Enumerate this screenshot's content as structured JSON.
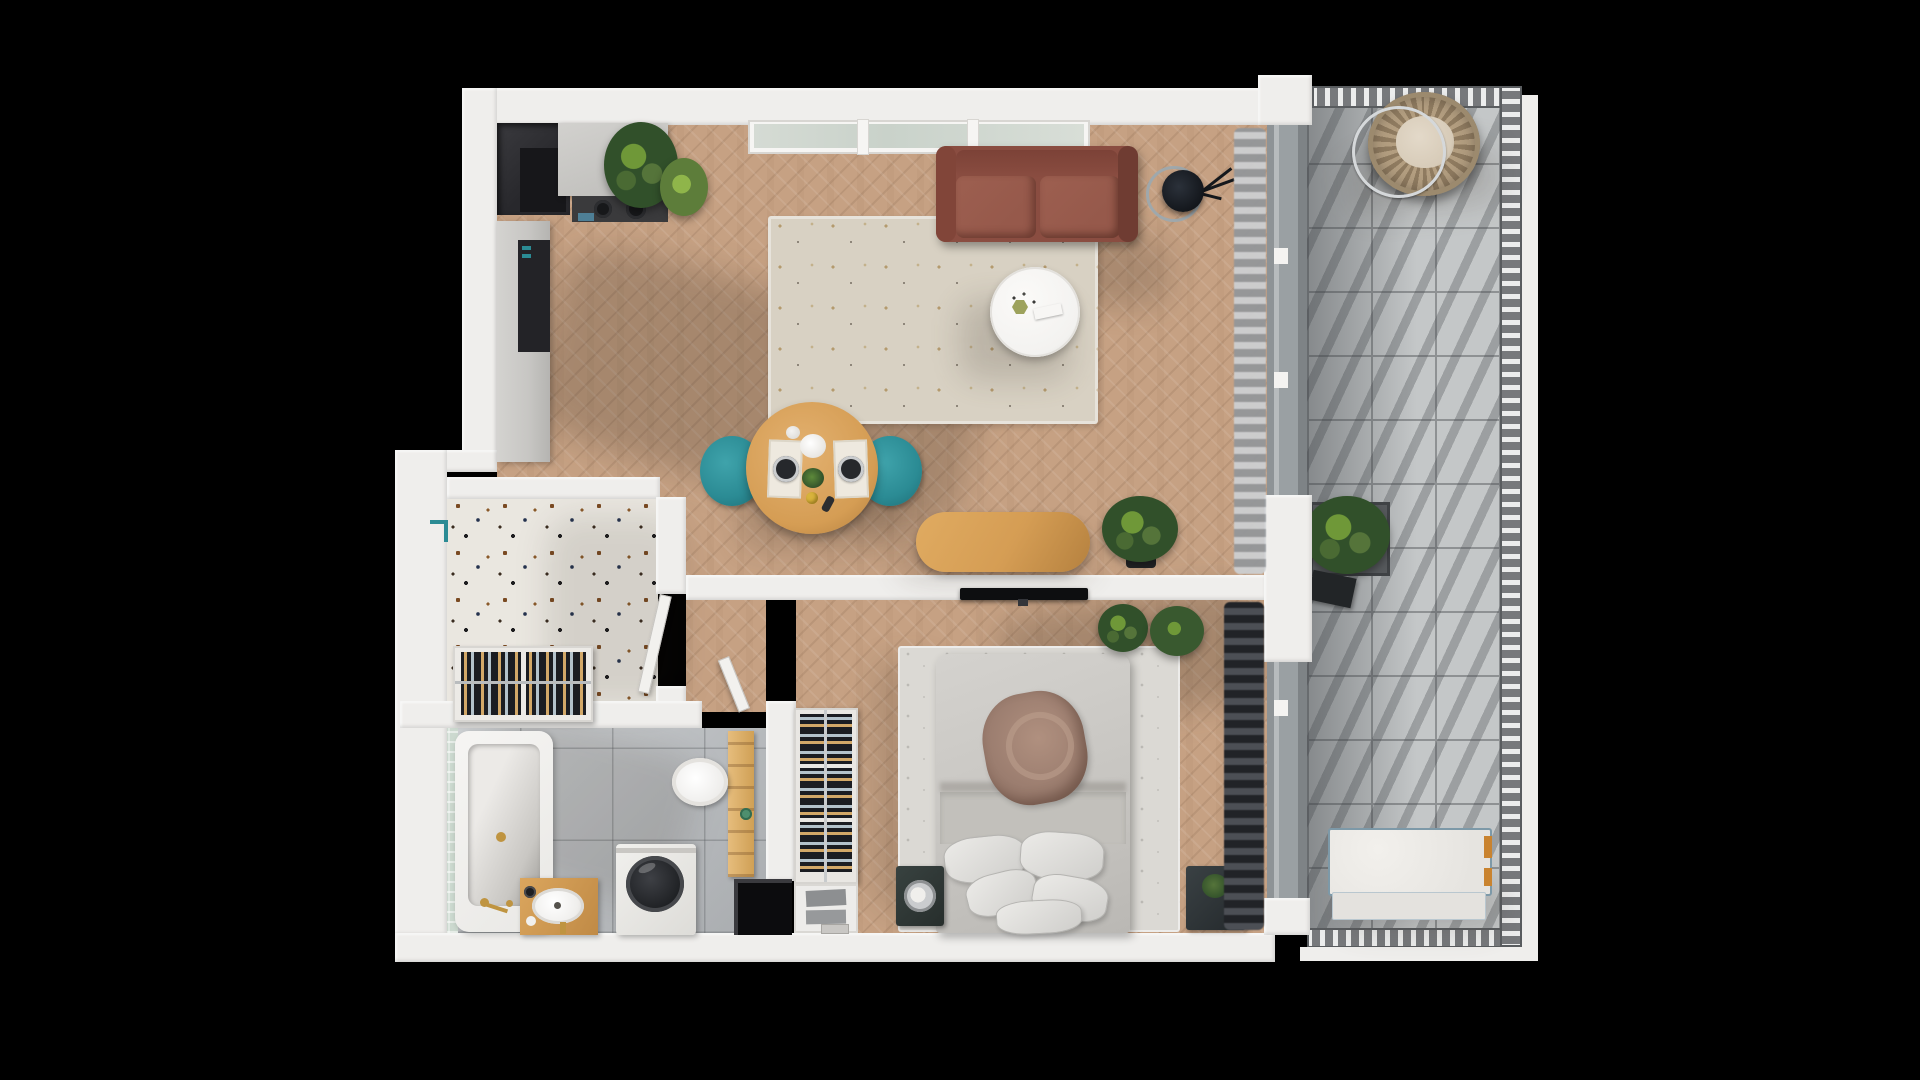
{
  "scene": {
    "type": "3d-floor-plan-top-view",
    "subject": "one-bedroom apartment with wraparound balcony",
    "background": "#000000"
  },
  "colors": {
    "wall": "#efeeec",
    "wood": "#c6a183",
    "terrazzo": "#eae7e0",
    "tileBath": "#b9bcbf",
    "tileBathLight": "#cfd2d4",
    "mosaic": "#ccd9cf",
    "balconyTile": "#c4c7c8",
    "grout": "#8e9193",
    "rail": "#77797c",
    "railLight": "#eceded",
    "rug": "#d8d1c3",
    "bedRug": "#dbd9d4",
    "sofa": "#8a4d41",
    "sofaCushion": "#96594b",
    "teal": "#2b8b94",
    "tableWood": "#d59d54",
    "white": "#f3f2f0",
    "tv": "#0d0e10",
    "curtainLight": "#b6b8ba",
    "curtainDark": "#3a3d42",
    "plantDark": "#31502a",
    "plantLight": "#6f9838",
    "bottleAmber": "#d2a868",
    "bottleSilver": "#b3c2cb",
    "cabinetGray": "#c7c6c3",
    "insetDark": "#232327",
    "niche": "#0c0c0e",
    "entryDark": "#28282c",
    "gold": "#bf9440",
    "benchFrame": "#7d99a8",
    "benchLeg": "#c9832f",
    "wicker": "#b39e80",
    "cushion": "#d7cbb8",
    "shadow": "rgba(52,40,30,0.22)"
  },
  "rooms": [
    {
      "id": "living-room",
      "floor": "herringbone wood"
    },
    {
      "id": "kitchen",
      "floor": "herringbone wood"
    },
    {
      "id": "entry-hall",
      "floor": "terrazzo"
    },
    {
      "id": "bathroom",
      "floor": "gray tile"
    },
    {
      "id": "bedroom",
      "floor": "herringbone wood"
    },
    {
      "id": "balcony",
      "floor": "concrete tile"
    }
  ],
  "furniture": {
    "kitchen": [
      "counter with cooktop",
      "two pans",
      "tall cabinet column",
      "entry niche"
    ],
    "living_room": [
      "terracotta sofa",
      "area rug",
      "round white coffee table",
      "tripod floor lamp",
      "round dining table",
      "two teal chairs",
      "oval wood console",
      "potted plants",
      "window band",
      "light curtain"
    ],
    "entry_hall": [
      "wall-mounted wine/shoe rack",
      "coat hook",
      "open door"
    ],
    "bathroom": [
      "bathtub with gold faucet",
      "green mosaic strip",
      "wood vanity with oval sink",
      "top-load washing machine",
      "wall-hung toilet",
      "wood towel ladder",
      "dark niche"
    ],
    "bedroom": [
      "double bed with pillows and brown throw",
      "bed rug",
      "wine storage column with drawers",
      "two nightstands",
      "two potted plants",
      "wall TV",
      "dark curtain"
    ],
    "balcony": [
      "hanging wicker egg chair",
      "planter box",
      "door mat",
      "white bench daybed",
      "perimeter railing"
    ]
  }
}
